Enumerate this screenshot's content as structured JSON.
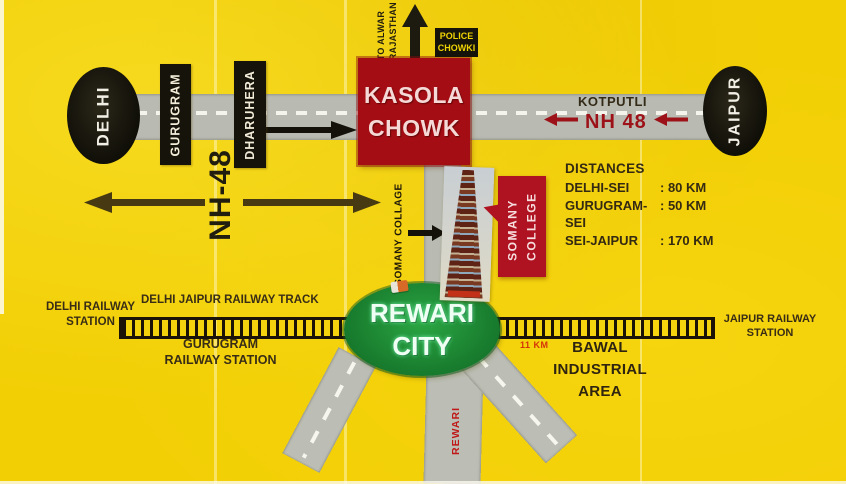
{
  "colors": {
    "background": "#F2CF05",
    "road_gray": "#B9BBB2",
    "sign_red": "#A30D13",
    "callout_red": "#AF1220",
    "oval_black": "#16130A",
    "city_green": "#1E9434",
    "nh48_red": "#9C1218",
    "distance_red": "#D5330A",
    "text_dark": "#342912"
  },
  "highway": {
    "delhi": "DELHI",
    "gurugram": "GURUGRAM",
    "dharuhera": "DHARUHERA",
    "nh48_vertical": "NH-48",
    "kotputli": "KOTPUTLI",
    "nh48_road": "NH 48",
    "jaipur": "JAIPUR"
  },
  "chowk": {
    "name": "KASOLA\nCHOWK",
    "police": "POLICE\nCHOWKI",
    "to_alwar": "TO ALWAR\nRAJASTHAN"
  },
  "college": {
    "road_label": "SOMANY COLLAGE",
    "callout": "SOMANY\nCOLLEGE"
  },
  "distances": {
    "title": "DISTANCES",
    "rows": [
      {
        "label": "DELHI-SEI",
        "value": ": 80 KM"
      },
      {
        "label": "GURUGRAM-SEI",
        "value": ": 50 KM"
      },
      {
        "label": "SEI-JAIPUR",
        "value": ": 170 KM"
      }
    ]
  },
  "railway": {
    "track_label": "DELHI JAIPUR RAILWAY TRACK",
    "delhi_station": "DELHI RAILWAY\nSTATION",
    "gurugram_station": "GURUGRAM\nRAILWAY STATION",
    "jaipur_station": "JAIPUR RAILWAY\nSTATION",
    "segment_distance": "11 KM"
  },
  "city": {
    "rewari": "REWARI\nCITY",
    "rewari_road": "REWARI",
    "bawal": "BAWAL\nINDUSTRIAL\nAREA"
  }
}
